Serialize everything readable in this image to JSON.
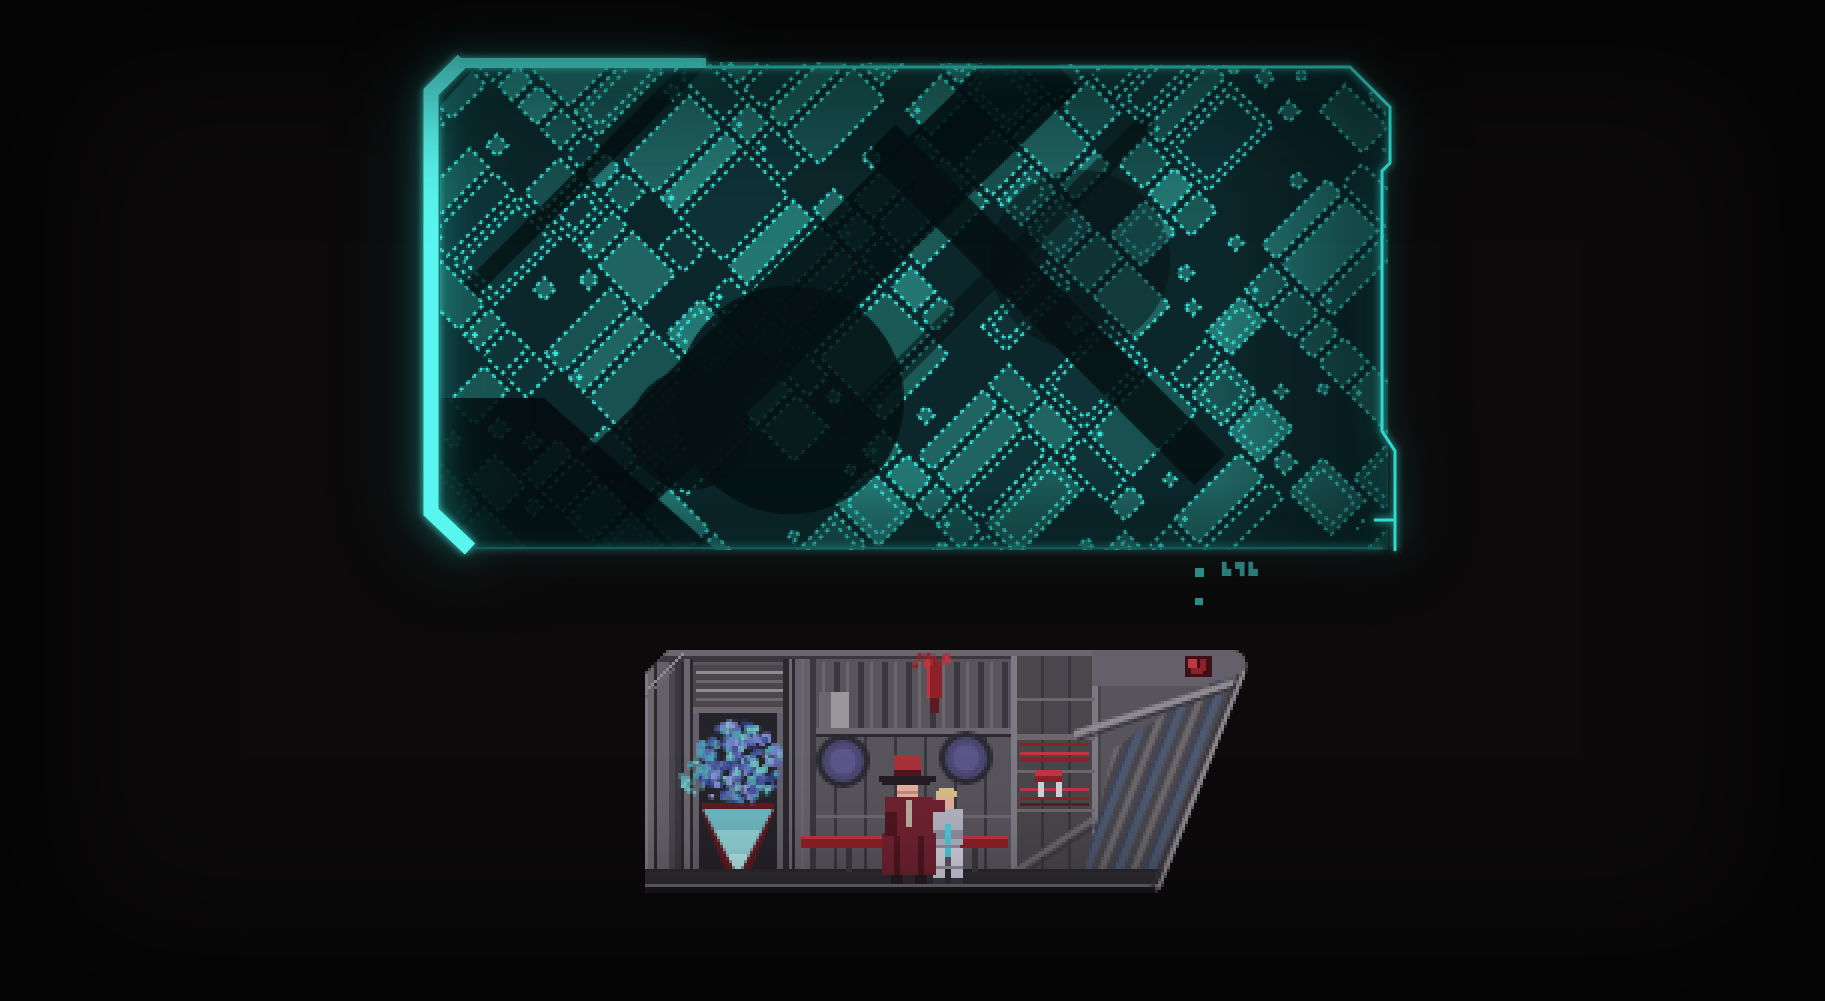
{
  "scene": {
    "type": "game-screenshot",
    "description": "holographic city map above a pixel-art ship interior",
    "background": "#0c0a0b",
    "viewport": {
      "width": 1825,
      "height": 1001
    }
  },
  "map_panel": {
    "name": "holographic-city-map",
    "frame_bar_color": "#58f6ee",
    "frame_color": "#4df2e8",
    "frame_thin_color": "#2edacd",
    "frame_dim_color": "#17635f",
    "grid_outline": "#3aeadb",
    "block_fill": "#206461",
    "block_fill_variants": [
      "#1b5956",
      "#206461",
      "#247672",
      "#185150"
    ],
    "block_fill_dark": "#0e3236",
    "backdrop": "#0c272b",
    "street": "#061317",
    "markers": {
      "square_color": "#2b8d89",
      "glyph_color": "#2a7c78",
      "glyphs": "▙▜▙",
      "dim_dot_color": "#1b5f5b"
    }
  },
  "ship_scene": {
    "name": "ship-interior-cross-section",
    "palette": {
      "hull_light": "#8f8b90",
      "hull_mid": "#6b676d",
      "light2": "#7d7982",
      "wall": "#57545b",
      "wall2": "#646069",
      "panel": "#49464c",
      "rib_dark": "#3a383e",
      "seam": "#2b292f",
      "near_black": "#19171b",
      "door_bg": "#25232a",
      "floor": "#302d33",
      "floor_dark": "#19181c",
      "ring": "#2b2931",
      "glass": "#4b4770",
      "glass2": "#5b5689",
      "pane": "#4e586e",
      "pane_dark": "#3b4457",
      "red_bright": "#c23440",
      "red_mid": "#8e2028",
      "red_dark": "#5f1a21",
      "cone_top": "#6fb6c0",
      "cone_mid": "#8fd0d4",
      "cone_tip": "#b2e4e4",
      "skin": "#e2ae9e",
      "skin_shade": "#c08a7c",
      "coat": "#6e2230",
      "coat_dark": "#4e1620",
      "hat_red": "#a83038",
      "hat_dark": "#241c22",
      "strap": "#b8ac9e",
      "hair": "#d4be82",
      "suit": "#b2b2c0",
      "suit_shade": "#8e8ea0",
      "suit_light": "#cfcfda",
      "cyan": "#4cc8d8",
      "pack": "#9898a8",
      "boot": "#3a3a46",
      "patch": "#9b979b"
    },
    "holo_colors": [
      "#323f8e",
      "#46549e",
      "#5a68b2",
      "#7280c6",
      "#8b96d4",
      "#4a9fae",
      "#6ec0c4"
    ]
  }
}
